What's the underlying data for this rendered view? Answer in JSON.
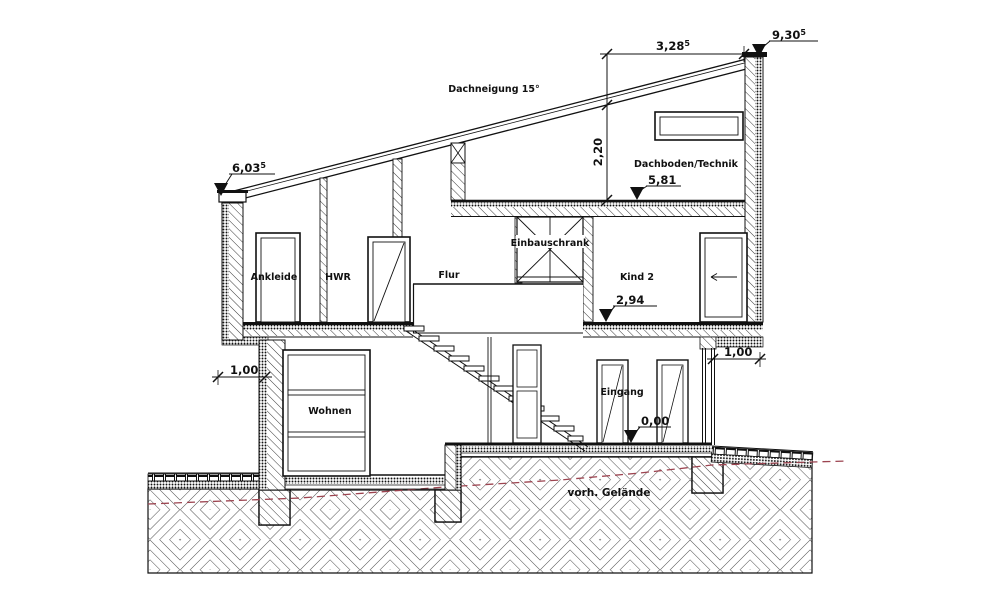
{
  "drawing": {
    "title": "building-cross-section",
    "annotations": {
      "roof_pitch": "Dachneigung 15°",
      "existing_terrain": "vorh. Gelände"
    },
    "rooms": {
      "ankleide": "Ankleide",
      "hwr": "HWR",
      "flur": "Flur",
      "einbauschrank": "Einbauschrank",
      "kind2": "Kind 2",
      "dachboden": "Dachboden/Technik",
      "wohnen": "Wohnen",
      "eingang": "Eingang"
    },
    "levels": {
      "eave_left": {
        "value": "6,03",
        "sup": "5"
      },
      "top_right": {
        "value": "9,30",
        "sup": "5"
      },
      "attic_floor": {
        "value": "5,81",
        "sup": ""
      },
      "upper_floor": {
        "value": "2,94",
        "sup": ""
      },
      "ground_floor": {
        "value": "0,00",
        "sup": ""
      }
    },
    "dimensions": {
      "roof_top_width": {
        "value": "3,28",
        "sup": "5"
      },
      "attic_height": {
        "value": "2,20",
        "sup": ""
      },
      "cantilever_left": {
        "value": "1,00",
        "sup": ""
      },
      "cantilever_right": {
        "value": "1,00",
        "sup": ""
      }
    },
    "colors": {
      "line": "#111111",
      "terrain_line": "#9c4450",
      "terrain_text": "#8b2030"
    }
  }
}
